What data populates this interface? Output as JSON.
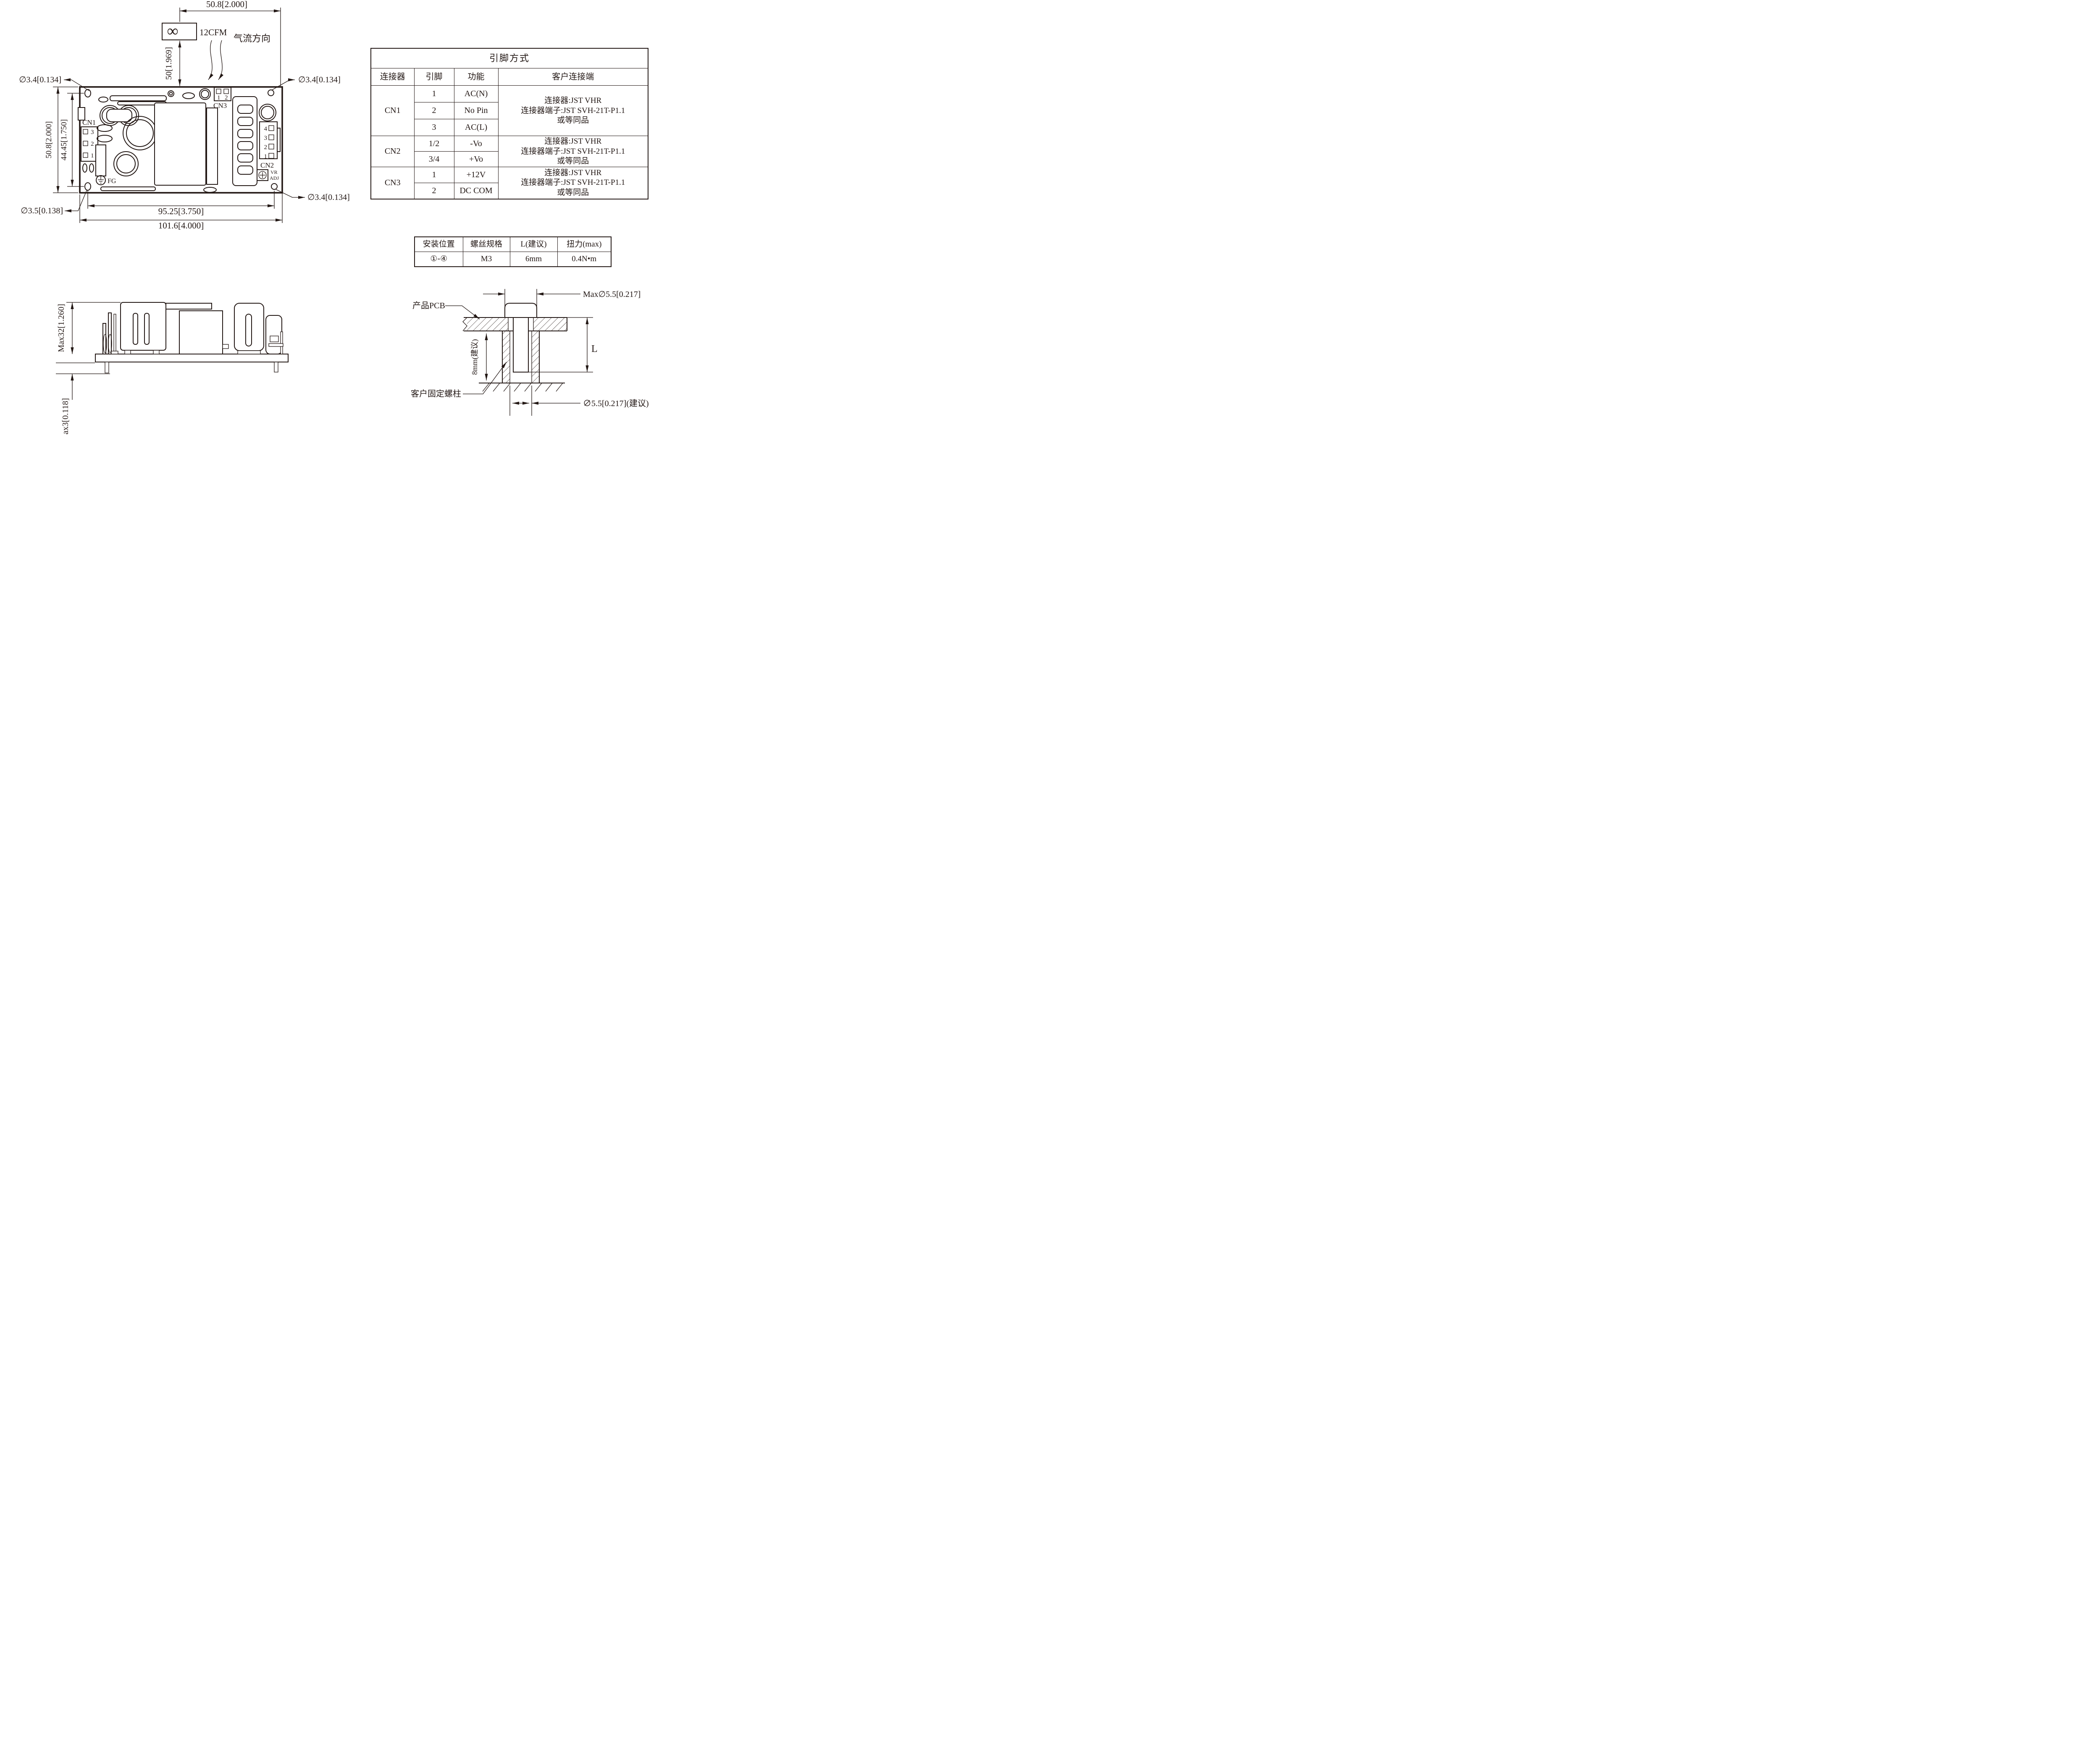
{
  "top": {
    "dim_fan_offset": "50.8[2.000]",
    "dim_fan_height": "50[1.969]",
    "fan_symbol": "∞",
    "fan_cfm": "12CFM",
    "airflow": "气流方向",
    "hole_tl": "∅3.4[0.134]",
    "hole_tr": "∅3.4[0.134]",
    "hole_br": "∅3.4[0.134]",
    "hole_bl": "∅3.5[0.138]",
    "dim_height_outer": "50.8[2.000]",
    "dim_height_inner": "44.45[1.750]",
    "dim_width_inner": "95.25[3.750]",
    "dim_width_outer": "101.6[4.000]",
    "cn1_label": "CN1",
    "cn2_label": "CN2",
    "cn3_label": "CN3",
    "cn1_pins": [
      "3",
      "2",
      "1"
    ],
    "cn2_pins": [
      "4",
      "3",
      "2",
      "1"
    ],
    "cn3_pins": [
      "1",
      "2"
    ],
    "fg_label": "FG",
    "vr_label": "VR",
    "adj_label": "ADJ"
  },
  "side": {
    "max_height": "Max32[1.260]",
    "max_pin": "Max3[0.118]"
  },
  "detail": {
    "pcb_label": "产品PCB",
    "standoff_label": "客户固定螺柱",
    "head_dia": "Max∅5.5[0.217]",
    "hole_dia": "∅5.5[0.217](建议)",
    "depth": "8mm(建议)",
    "length": "L"
  },
  "pin_table": {
    "title": "引脚方式",
    "headers": [
      "连接器",
      "引脚",
      "功能",
      "客户连接端"
    ],
    "groups": [
      {
        "connector": "CN1",
        "rows": [
          [
            "1",
            "AC(N)"
          ],
          [
            "2",
            "No Pin"
          ],
          [
            "3",
            "AC(L)"
          ]
        ],
        "client": [
          "连接器:JST VHR",
          "连接器端子:JST SVH-21T-P1.1",
          "或等同品"
        ]
      },
      {
        "connector": "CN2",
        "rows": [
          [
            "1/2",
            "-Vo"
          ],
          [
            "3/4",
            "+Vo"
          ]
        ],
        "client": [
          "连接器:JST VHR",
          "连接器端子:JST SVH-21T-P1.1",
          "或等同品"
        ]
      },
      {
        "connector": "CN3",
        "rows": [
          [
            "1",
            "+12V"
          ],
          [
            "2",
            "DC COM"
          ]
        ],
        "client": [
          "连接器:JST VHR",
          "连接器端子:JST SVH-21T-P1.1",
          "或等同品"
        ]
      }
    ]
  },
  "screw_table": {
    "headers": [
      "安装位置",
      "螺丝规格",
      "L(建议)",
      "扭力(max)"
    ],
    "row": [
      "①-④",
      "M3",
      "6mm",
      "0.4N•m"
    ]
  }
}
